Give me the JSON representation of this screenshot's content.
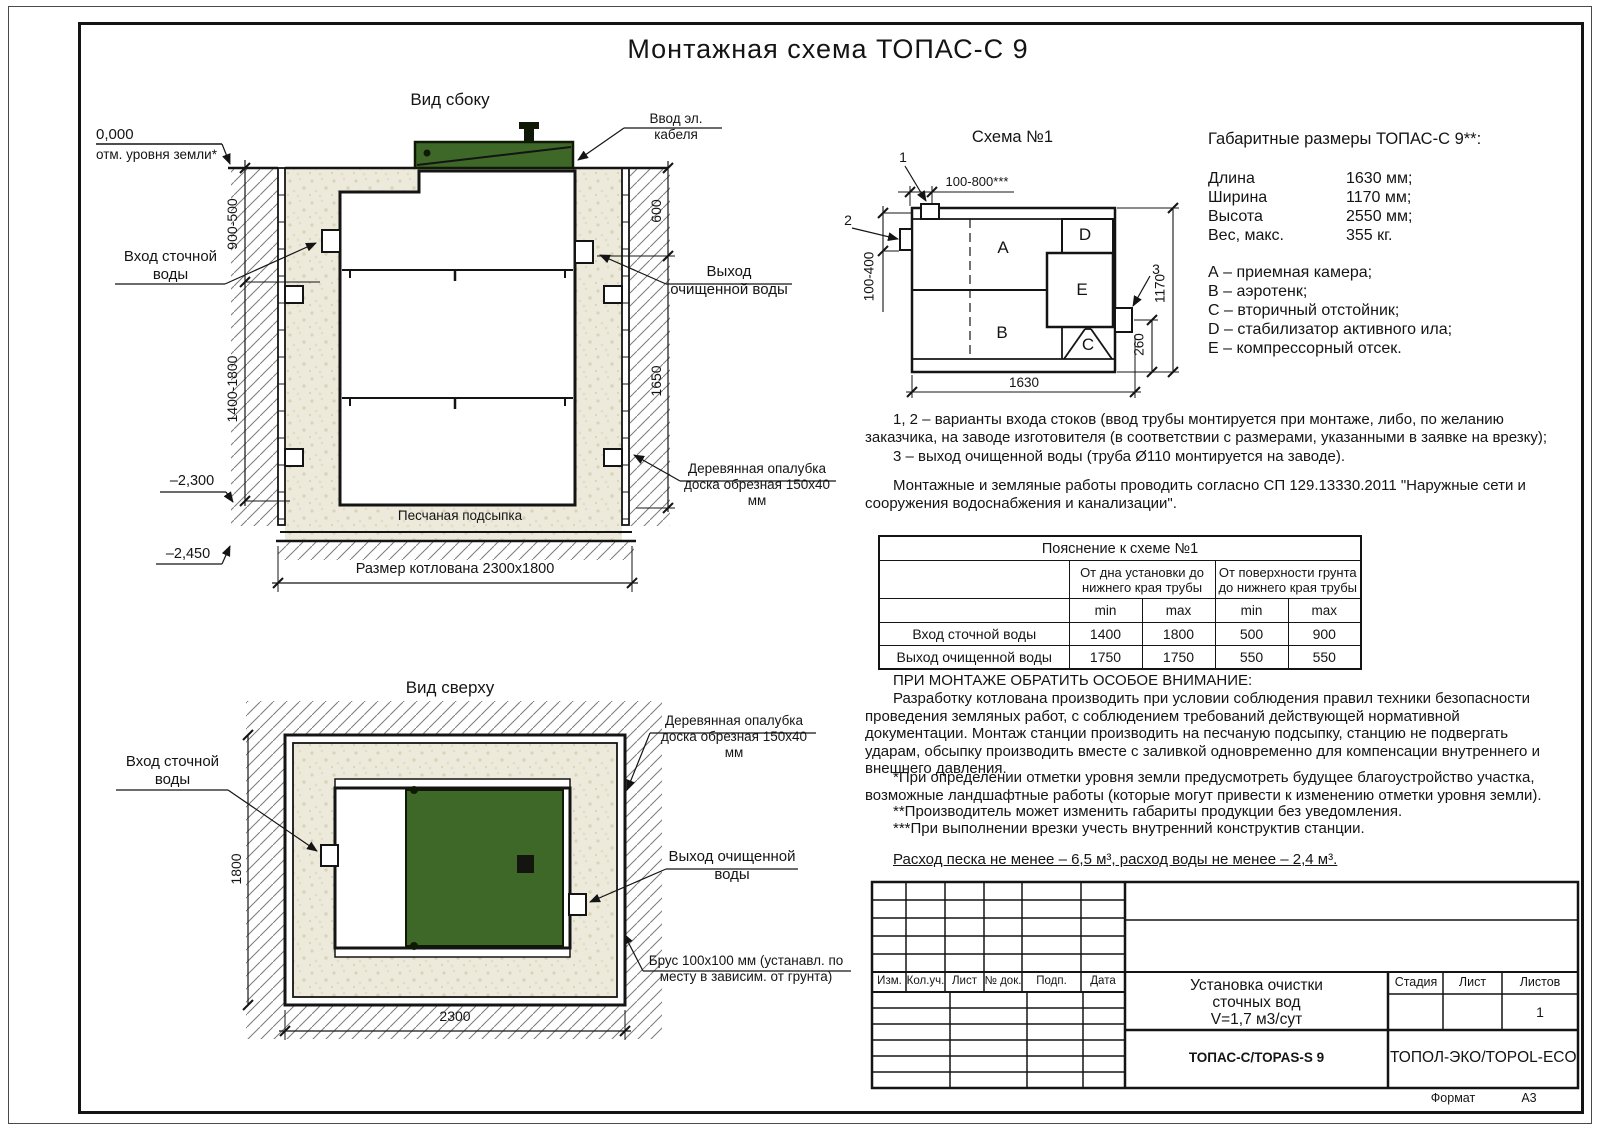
{
  "title": "Монтажная схема ТОПАС-С 9",
  "colors": {
    "lid_green": "#3d6828",
    "lid_dark": "#101806",
    "sand": "#edeadb",
    "hatch": "#7a7a7a",
    "line": "#141414"
  },
  "side_view": {
    "title": "Вид сбоку",
    "zero_mark": "0,000",
    "ground_label": "отм. уровня земли*",
    "inlet_label": "Вход сточной воды",
    "cable_label": "Ввод эл. кабеля",
    "outlet_label": "Выход очищенной воды",
    "formwork_label": "Деревянная опалубка доска обрезная 150x40 мм",
    "sand_base_label": "Песчаная подсыпка",
    "pit_size_label": "Размер котлована 2300x1800",
    "dims": {
      "surface_range": "900-500",
      "depth_range": "1400-1800",
      "right_upper": "600",
      "right_lower": "1650",
      "level_bottom": "–2,300",
      "level_pit": "–2,450"
    }
  },
  "top_view": {
    "title": "Вид сверху",
    "inlet_label": "Вход сточной воды",
    "formwork_label": "Деревянная опалубка доска обрезная 150x40 мм",
    "outlet_label": "Выход очищенной воды",
    "beam_label": "Брус 100x100 мм (устанавл. по месту в зависим. от грунта)",
    "dims": {
      "width": "1800",
      "length": "2300"
    }
  },
  "schema": {
    "title": "Схема №1",
    "compartments": {
      "a": "A",
      "b": "B",
      "c": "C",
      "d": "D",
      "e": "E"
    },
    "markers": {
      "m1": "1",
      "m2": "2",
      "m3": "3"
    },
    "dims": {
      "top": "100-800***",
      "left": "100-400",
      "height": "1170",
      "outlet": "260",
      "length": "1630"
    }
  },
  "dimensions_info": {
    "heading": "Габаритные размеры ТОПАС-С 9**:",
    "rows": [
      {
        "label": "Длина",
        "value": "1630 мм;"
      },
      {
        "label": "Ширина",
        "value": "1170 мм;"
      },
      {
        "label": "Высота",
        "value": "2550 мм;"
      },
      {
        "label": "Вес, макс.",
        "value": "355 кг."
      }
    ],
    "legend": [
      "А – приемная камера;",
      "В – аэротенк;",
      "С – вторичный отстойник;",
      "D – стабилизатор активного ила;",
      "Е – компрессорный отсек."
    ]
  },
  "notes": {
    "variant_12": "1, 2 – варианты входа  стоков (ввод трубы монтируется при монтаже, либо, по желанию заказчика, на заводе изготовителя (в соответствии с размерами, указанными в заявке на врезку);",
    "variant_3": "3 – выход очищенной воды (труба Ø110 монтируется на заводе).",
    "works": "Монтажные и земляные работы проводить согласно СП 129.13330.2011 \"Наружные сети и сооружения водоснабжения и канализации\"."
  },
  "table": {
    "caption": "Пояснение к схеме №1",
    "group1": "От дна установки до нижнего края трубы",
    "group2": "От поверхности грунта до нижнего края трубы",
    "min": "min",
    "max": "max",
    "rows": [
      {
        "label": "Вход сточной воды",
        "values": [
          "1400",
          "1800",
          "500",
          "900"
        ]
      },
      {
        "label": "Выход очищенной воды",
        "values": [
          "1750",
          "1750",
          "550",
          "550"
        ]
      }
    ]
  },
  "attention": {
    "heading": "ПРИ МОНТАЖЕ ОБРАТИТЬ ОСОБОЕ ВНИМАНИЕ:",
    "body": "Разработку котлована производить при условии соблюдения правил техники безопасности проведения земляных работ, с соблюдением требований действующей нормативной документации. Монтаж станции производить на песчаную подсыпку, станцию не подвергать ударам, обсыпку производить вместе с заливкой одновременно для компенсации внутреннего и внешнего давления."
  },
  "footnotes": [
    "*При определении отметки уровня земли предусмотреть будущее благоустройство участка, возможные ландшафтные работы (которые могут привести к изменению отметки уровня земли).",
    "**Производитель может изменить габариты продукции без уведомления.",
    "***При выполнении врезки учесть внутренний конструктив станции."
  ],
  "consumption": "Расход песка не менее – 6,5 м³, расход воды не менее – 2,4 м³.",
  "title_block": {
    "rev_headers": [
      "Изм.",
      "Кол.уч.",
      "Лист",
      "№ док.",
      "Подп.",
      "Дата"
    ],
    "product_lines": [
      "Установка очистки",
      "сточных вод",
      "V=1,7 м3/сут"
    ],
    "model": "ТОПАС-С/TOPAS-S 9",
    "company": "ТОПОЛ-ЭКО/TOPOL-ECO",
    "stage_label": "Стадия",
    "sheet_label": "Лист",
    "sheets_label": "Листов",
    "sheets_value": "1",
    "format_label": "Формат",
    "format_value": "А3"
  }
}
